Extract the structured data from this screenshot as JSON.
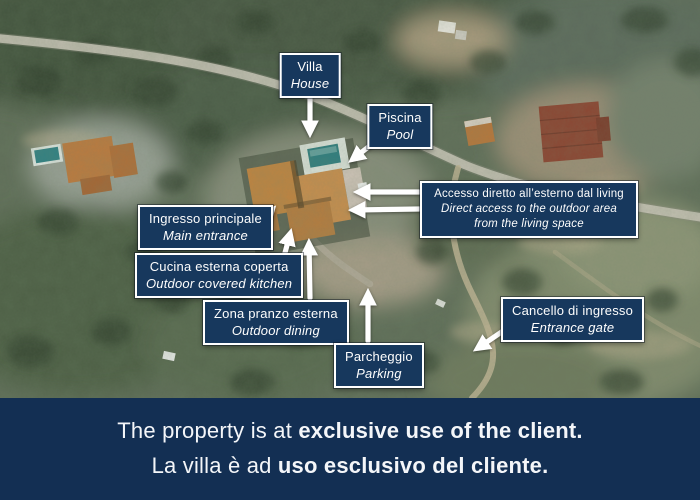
{
  "map": {
    "labels": [
      {
        "id": "villa",
        "it": "Villa",
        "en": "House"
      },
      {
        "id": "piscina",
        "it": "Piscina",
        "en": "Pool"
      },
      {
        "id": "accesso",
        "it": "Accesso diretto all’esterno dal living",
        "en": "Direct access to the outdoor area from the living space"
      },
      {
        "id": "ingresso",
        "it": "Ingresso principale",
        "en": "Main entrance"
      },
      {
        "id": "cucina",
        "it": "Cucina esterna coperta",
        "en": "Outdoor covered kitchen"
      },
      {
        "id": "zona",
        "it": "Zona pranzo esterna",
        "en": "Outdoor dining"
      },
      {
        "id": "parcheggio",
        "it": "Parcheggio",
        "en": "Parking"
      },
      {
        "id": "cancello",
        "it": "Cancello di ingresso",
        "en": "Entrance gate"
      }
    ],
    "colors": {
      "label_background": "#17385d",
      "label_border": "#ffffff",
      "arrow": "#ffffff"
    }
  },
  "banner": {
    "line1_regular": "The property is at ",
    "line1_bold": "exclusive use of the client.",
    "line2_regular": "La villa è ad ",
    "line2_bold": "uso esclusivo del cliente.",
    "background": "#132f53",
    "text_color": "#f4f6f9"
  }
}
